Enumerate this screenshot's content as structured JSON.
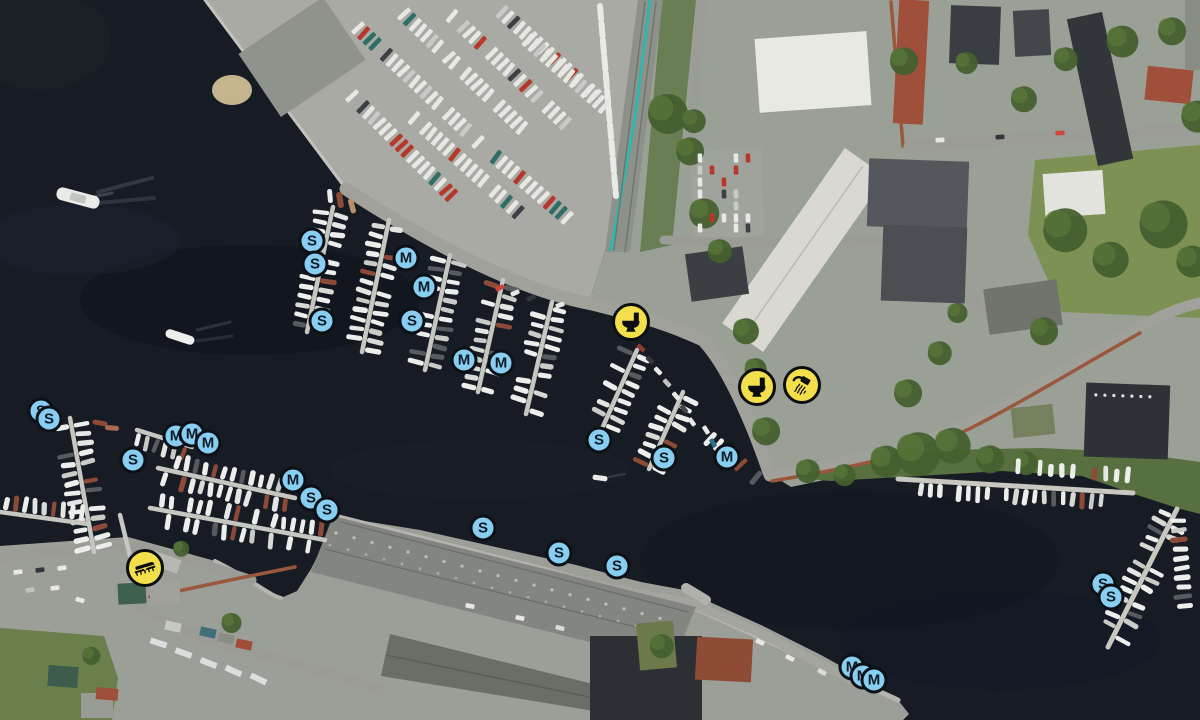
{
  "map": {
    "colors": {
      "berth_fill": "#87cef2",
      "berth_ring": "#0c1117",
      "berth_glyph": "#0d1a24",
      "service_fill": "#f2df4b",
      "service_ring": "#0c0e11",
      "service_glyph": "#0b0d10"
    },
    "markers": [
      {
        "kind": "berth",
        "label": "S",
        "x": 312,
        "y": 241
      },
      {
        "kind": "berth",
        "label": "S",
        "x": 315,
        "y": 264
      },
      {
        "kind": "berth",
        "label": "M",
        "x": 406,
        "y": 258
      },
      {
        "kind": "berth",
        "label": "M",
        "x": 424,
        "y": 287
      },
      {
        "kind": "berth",
        "label": "S",
        "x": 322,
        "y": 321
      },
      {
        "kind": "berth",
        "label": "S",
        "x": 412,
        "y": 321
      },
      {
        "kind": "berth",
        "label": "M",
        "x": 464,
        "y": 360
      },
      {
        "kind": "berth",
        "label": "M",
        "x": 501,
        "y": 363
      },
      {
        "kind": "berth",
        "label": "S",
        "x": 41,
        "y": 411
      },
      {
        "kind": "berth",
        "label": "S",
        "x": 49,
        "y": 419
      },
      {
        "kind": "berth",
        "label": "M",
        "x": 176,
        "y": 436
      },
      {
        "kind": "berth",
        "label": "M",
        "x": 192,
        "y": 434
      },
      {
        "kind": "berth",
        "label": "M",
        "x": 208,
        "y": 443
      },
      {
        "kind": "berth",
        "label": "S",
        "x": 133,
        "y": 460
      },
      {
        "kind": "berth",
        "label": "M",
        "x": 293,
        "y": 480
      },
      {
        "kind": "berth",
        "label": "S",
        "x": 311,
        "y": 498
      },
      {
        "kind": "berth",
        "label": "S",
        "x": 327,
        "y": 510
      },
      {
        "kind": "berth",
        "label": "S",
        "x": 599,
        "y": 440
      },
      {
        "kind": "berth",
        "label": "S",
        "x": 664,
        "y": 458
      },
      {
        "kind": "berth",
        "label": "M",
        "x": 727,
        "y": 457
      },
      {
        "kind": "berth",
        "label": "S",
        "x": 483,
        "y": 528
      },
      {
        "kind": "berth",
        "label": "S",
        "x": 559,
        "y": 553
      },
      {
        "kind": "berth",
        "label": "S",
        "x": 617,
        "y": 566
      },
      {
        "kind": "berth",
        "label": "S",
        "x": 1103,
        "y": 584
      },
      {
        "kind": "berth",
        "label": "S",
        "x": 1111,
        "y": 597
      },
      {
        "kind": "berth",
        "label": "M",
        "x": 852,
        "y": 667
      },
      {
        "kind": "berth",
        "label": "M",
        "x": 863,
        "y": 676
      },
      {
        "kind": "berth",
        "label": "M",
        "x": 874,
        "y": 680
      },
      {
        "kind": "service",
        "icon": "toilet-icon",
        "x": 631,
        "y": 322
      },
      {
        "kind": "service",
        "icon": "toilet-icon",
        "x": 757,
        "y": 387
      },
      {
        "kind": "service",
        "icon": "shower-icon",
        "x": 802,
        "y": 385
      },
      {
        "kind": "service",
        "icon": "slipway-icon",
        "x": 145,
        "y": 568
      }
    ]
  }
}
